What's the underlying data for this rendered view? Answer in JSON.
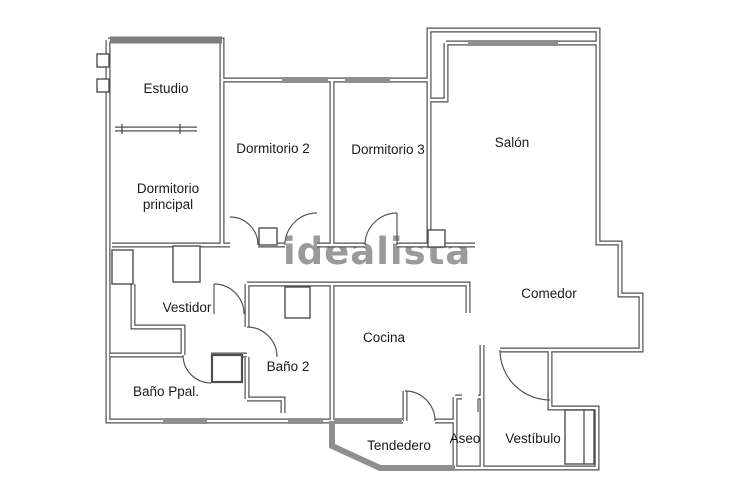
{
  "watermark": {
    "text": "idealista"
  },
  "colors": {
    "wall": "#4f4f4f",
    "glazing": "#8f8f8f",
    "watermark": "#9a9a9a",
    "label_text": "#1a1a1a",
    "background": "#ffffff"
  },
  "rooms": {
    "estudio": {
      "label": "Estudio"
    },
    "dormitorio2": {
      "label": "Dormitorio 2"
    },
    "dormitorio3": {
      "label": "Dormitorio 3"
    },
    "salon": {
      "label": "Salón"
    },
    "principal": {
      "line1": "Dormitorio",
      "line2": "principal"
    },
    "vestidor": {
      "label": "Vestidor"
    },
    "comedor": {
      "label": "Comedor"
    },
    "cocina": {
      "label": "Cocina"
    },
    "bano2": {
      "label": "Baño 2"
    },
    "bano_ppal": {
      "label": "Baño Ppal."
    },
    "tendedero": {
      "label": "Tendedero"
    },
    "aseo": {
      "label": "Aseo"
    },
    "vestibulo": {
      "label": "Vestíbulo"
    }
  }
}
